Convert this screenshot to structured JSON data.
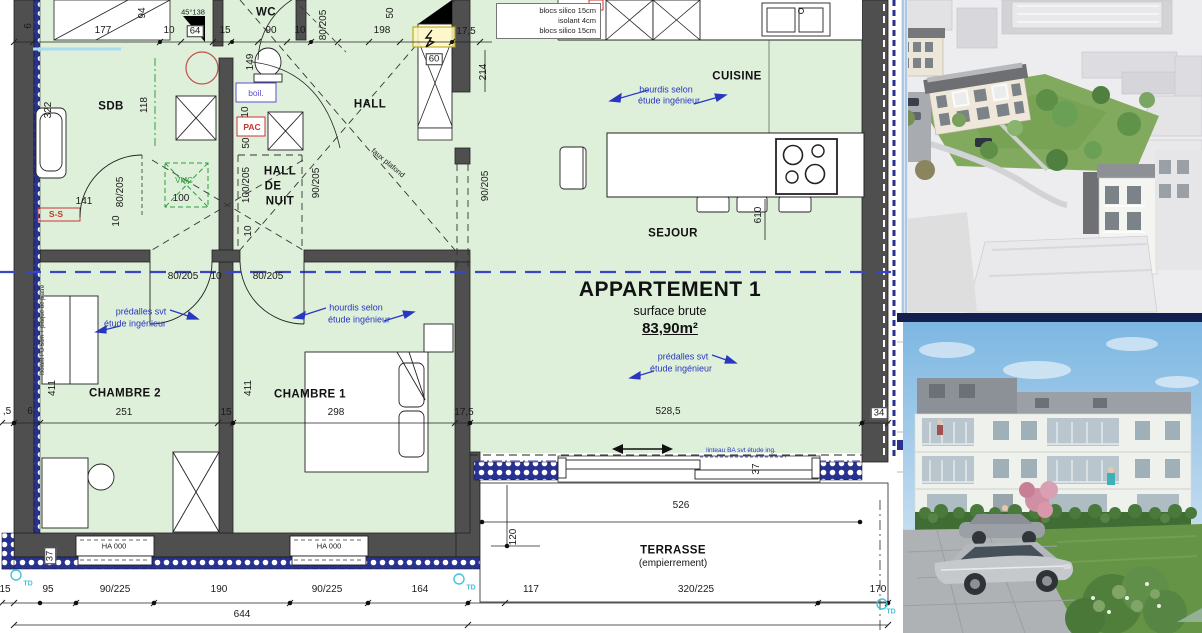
{
  "plan": {
    "apartment": {
      "title": "APPARTEMENT 1",
      "subtitle": "surface brute",
      "area": "83,90m²"
    },
    "materials_box": [
      "blocs silico 15cm",
      "isolant 4cm",
      "blocs silico 15cm"
    ],
    "labels": [
      {
        "t": "6",
        "x": 29,
        "y": 26,
        "r": -90
      },
      {
        "t": "177",
        "x": 103,
        "y": 31
      },
      {
        "t": "94",
        "x": 143,
        "y": 13,
        "r": -90
      },
      {
        "t": "10",
        "x": 169,
        "y": 31
      },
      {
        "t": "45°138",
        "x": 193,
        "y": 12,
        "c": "sm"
      },
      {
        "t": "64",
        "x": 195,
        "y": 31,
        "c": "box"
      },
      {
        "t": "15",
        "x": 225,
        "y": 31
      },
      {
        "t": "WC",
        "x": 266,
        "y": 13,
        "c": "room",
        "n": "room-label-wc"
      },
      {
        "t": "90",
        "x": 271,
        "y": 31
      },
      {
        "t": "10",
        "x": 300,
        "y": 31
      },
      {
        "t": "80/205",
        "x": 324,
        "y": 25,
        "r": -90
      },
      {
        "t": "198",
        "x": 382,
        "y": 31
      },
      {
        "t": "50",
        "x": 391,
        "y": 13,
        "r": -90
      },
      {
        "t": "17,5",
        "x": 466,
        "y": 32
      },
      {
        "t": "60",
        "x": 434,
        "y": 59,
        "c": "box"
      },
      {
        "t": "214",
        "x": 484,
        "y": 72,
        "r": -90
      },
      {
        "t": "322",
        "x": 49,
        "y": 110,
        "r": -90
      },
      {
        "t": "SDB",
        "x": 111,
        "y": 107,
        "c": "room",
        "n": "room-label-sdb"
      },
      {
        "t": "118",
        "x": 145,
        "y": 105,
        "r": -90
      },
      {
        "t": "149",
        "x": 251,
        "y": 62,
        "r": -90
      },
      {
        "t": "boil.",
        "x": 256,
        "y": 93,
        "c": "boil",
        "n": "boiler-label"
      },
      {
        "t": "10",
        "x": 246,
        "y": 112,
        "r": -90
      },
      {
        "t": "PAC",
        "x": 252,
        "y": 127,
        "c": "red",
        "n": "heat-pump-label"
      },
      {
        "t": "50",
        "x": 247,
        "y": 143,
        "r": -90
      },
      {
        "t": "141",
        "x": 84,
        "y": 202
      },
      {
        "t": "80/205",
        "x": 121,
        "y": 192,
        "r": -90
      },
      {
        "t": "10",
        "x": 117,
        "y": 221,
        "r": -90
      },
      {
        "t": "S-S",
        "x": 56,
        "y": 214,
        "c": "red",
        "n": "towel-radiator-label"
      },
      {
        "t": "VMC",
        "x": 184,
        "y": 181,
        "c": "grn",
        "n": "vmc-label"
      },
      {
        "t": "100",
        "x": 181,
        "y": 199
      },
      {
        "t": "100/205",
        "x": 247,
        "y": 185,
        "r": -90
      },
      {
        "t": "HALL",
        "x": 280,
        "y": 172,
        "c": "room",
        "n": "room-label-hall-de-nuit"
      },
      {
        "t": "DE",
        "x": 273,
        "y": 187,
        "c": "room"
      },
      {
        "t": "NUIT",
        "x": 280,
        "y": 202,
        "c": "room"
      },
      {
        "t": "90/205",
        "x": 317,
        "y": 183,
        "r": -90
      },
      {
        "t": "HALL",
        "x": 370,
        "y": 105,
        "c": "room",
        "n": "room-label-hall"
      },
      {
        "t": "faux plafond",
        "x": 388,
        "y": 163,
        "r": 40,
        "c": "sm"
      },
      {
        "t": "90/205",
        "x": 486,
        "y": 186,
        "r": -90
      },
      {
        "t": "10",
        "x": 249,
        "y": 231,
        "r": -90
      },
      {
        "t": "80/205",
        "x": 183,
        "y": 277
      },
      {
        "t": "10",
        "x": 216,
        "y": 277
      },
      {
        "t": "80/205",
        "x": 268,
        "y": 277
      },
      {
        "t": "CUISINE",
        "x": 737,
        "y": 77,
        "c": "room",
        "n": "room-label-cuisine"
      },
      {
        "t": "hourdis selon",
        "x": 666,
        "y": 90,
        "c": "blue"
      },
      {
        "t": "étude ingénieur",
        "x": 669,
        "y": 101,
        "c": "blue"
      },
      {
        "t": "SEJOUR",
        "x": 673,
        "y": 234,
        "c": "room",
        "n": "room-label-sejour"
      },
      {
        "t": "610",
        "x": 759,
        "y": 215,
        "r": -90
      },
      {
        "t": "prédalles svt",
        "x": 683,
        "y": 357,
        "c": "blue"
      },
      {
        "t": "étude ingénieur",
        "x": 681,
        "y": 369,
        "c": "blue"
      },
      {
        "t": "prédalles svt",
        "x": 141,
        "y": 312,
        "c": "blue"
      },
      {
        "t": "étude ingénieur",
        "x": 135,
        "y": 324,
        "c": "blue"
      },
      {
        "t": "hourdis selon",
        "x": 356,
        "y": 308,
        "c": "blue"
      },
      {
        "t": "étude ingénieur",
        "x": 359,
        "y": 320,
        "c": "blue"
      },
      {
        "t": "linteau BA svt étude ing.",
        "x": 741,
        "y": 451,
        "c": "bluesm"
      },
      {
        "t": "411",
        "x": 53,
        "y": 388,
        "r": -90
      },
      {
        "t": "CHAMBRE 2",
        "x": 125,
        "y": 394,
        "c": "room",
        "n": "room-label-chambre-2"
      },
      {
        "t": "251",
        "x": 124,
        "y": 413
      },
      {
        "t": "15",
        "x": 226,
        "y": 413
      },
      {
        "t": "411",
        "x": 249,
        "y": 388,
        "r": -90
      },
      {
        "t": "CHAMBRE 1",
        "x": 310,
        "y": 395,
        "c": "room",
        "n": "room-label-chambre-1"
      },
      {
        "t": "298",
        "x": 336,
        "y": 413
      },
      {
        "t": "17,5",
        "x": 464,
        "y": 413
      },
      {
        "t": "528,5",
        "x": 668,
        "y": 412
      },
      {
        "t": "34",
        "x": 879,
        "y": 413,
        "c": "box"
      },
      {
        "t": "37",
        "x": 757,
        "y": 469,
        "r": -90
      },
      {
        "t": ",5",
        "x": 7,
        "y": 412
      },
      {
        "t": "6",
        "x": 30,
        "y": 412
      },
      {
        "t": "HA 000",
        "x": 114,
        "y": 546,
        "c": "sm",
        "n": "window-tag"
      },
      {
        "t": "HA 000",
        "x": 329,
        "y": 546,
        "c": "sm",
        "n": "window-tag"
      },
      {
        "t": "37",
        "x": 50,
        "y": 556,
        "r": -90,
        "c": "box"
      },
      {
        "t": "526",
        "x": 681,
        "y": 506
      },
      {
        "t": "120",
        "x": 514,
        "y": 537,
        "r": -90
      },
      {
        "t": "TERRASSE",
        "x": 673,
        "y": 551,
        "c": "room",
        "n": "room-label-terrasse"
      },
      {
        "t": "(empierrement)",
        "x": 673,
        "y": 564,
        "c": "roomsub"
      },
      {
        "t": "15",
        "x": 5,
        "y": 590
      },
      {
        "t": "95",
        "x": 48,
        "y": 590
      },
      {
        "t": "90/225",
        "x": 115,
        "y": 590
      },
      {
        "t": "190",
        "x": 219,
        "y": 590
      },
      {
        "t": "90/225",
        "x": 327,
        "y": 590
      },
      {
        "t": "164",
        "x": 420,
        "y": 590
      },
      {
        "t": "117",
        "x": 531,
        "y": 590
      },
      {
        "t": "320/225",
        "x": 696,
        "y": 590
      },
      {
        "t": "170",
        "x": 878,
        "y": 590
      },
      {
        "t": "644",
        "x": 242,
        "y": 615
      },
      {
        "t": "TD",
        "x": 28,
        "y": 584,
        "c": "cyan",
        "n": "downpipe-label"
      },
      {
        "t": "TD",
        "x": 471,
        "y": 588,
        "c": "cyan",
        "n": "downpipe-label"
      },
      {
        "t": "TD",
        "x": 891,
        "y": 612,
        "c": "cyan",
        "n": "downpipe-label"
      },
      {
        "t": "isolant PU 5cm + plaque de plâtre",
        "x": 43,
        "y": 330,
        "r": -90,
        "c": "tiny"
      }
    ]
  },
  "colors": {
    "room_fill": "#def0da",
    "wall": "#4f4f4f",
    "insulation_navy": "#27318f",
    "annotation_blue": "#2936c0",
    "apartment_boundary_blue": "#3a46c8",
    "equipment_red": "#cc3333",
    "vmc_green": "#2e9e3e",
    "td_cyan": "#45c3d8",
    "sky": "#8fc0e4",
    "lawn": "#6f9c4f",
    "facade_white": "#eef1ec",
    "roof_zinc": "#9aa0a6"
  },
  "renders": {
    "aerial": {
      "name": "aerial-site-render"
    },
    "street": {
      "name": "street-view-render"
    }
  }
}
